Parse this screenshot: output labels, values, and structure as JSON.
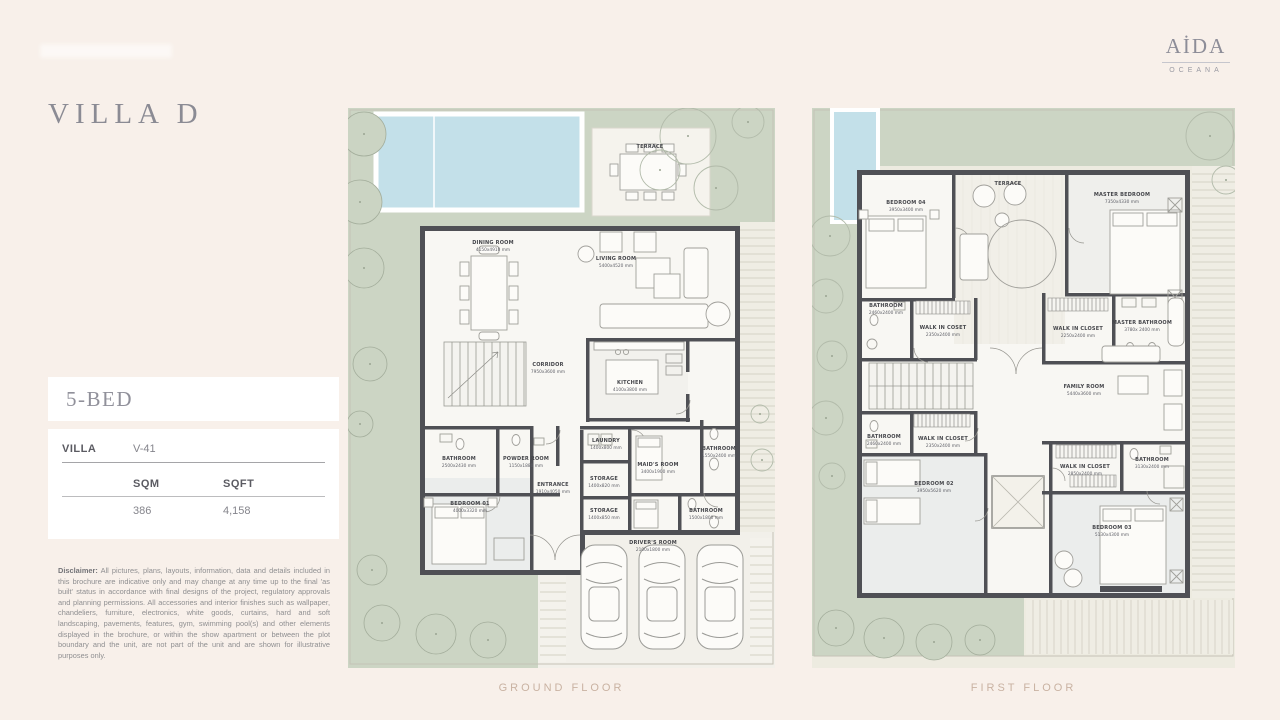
{
  "brand": {
    "name": "AİDA",
    "sub": "OCEANA"
  },
  "page": {
    "title": "VILLA D"
  },
  "unit": {
    "bed_label": "5-BED",
    "villa_label": "VILLA",
    "villa_value": "V-41",
    "sqm_label": "SQM",
    "sqft_label": "SQFT",
    "sqm_value": "386",
    "sqft_value": "4,158"
  },
  "disclaimer": {
    "label": "Disclaimer:",
    "text": "All pictures, plans, layouts, information, data and details included in this brochure are indicative only and may change at any time up to the final 'as built' status in accordance with final designs of the project, regulatory approvals and planning permissions. All accessories and interior finishes such as wallpaper, chandeliers, furniture, electronics, white goods, curtains, hard and soft landscaping, pavements, features, gym, swimming pool(s) and other elements displayed in the brochure, or within the show apartment or between the plot boundary and the unit, are not part of the unit and are shown for illustrative purposes only."
  },
  "floors": {
    "ground": {
      "caption": "GROUND FLOOR",
      "rooms": [
        {
          "name": "TERRACE",
          "dims": ""
        },
        {
          "name": "DINING ROOM",
          "dims": "4150x4910 mm"
        },
        {
          "name": "LIVING ROOM",
          "dims": "5400x4520 mm"
        },
        {
          "name": "CORRIDOR",
          "dims": "7950x3600 mm"
        },
        {
          "name": "KITCHEN",
          "dims": "4100x3800 mm"
        },
        {
          "name": "LAUNDRY",
          "dims": "1400x800 mm"
        },
        {
          "name": "MAID'S ROOM",
          "dims": "3400x1900 mm"
        },
        {
          "name": "BATHROOM",
          "dims": "1550x2400 mm"
        },
        {
          "name": "ENTRANCE",
          "dims": "1910x4050 mm"
        },
        {
          "name": "STORAGE",
          "dims": "1400x820 mm"
        },
        {
          "name": "STORAGE",
          "dims": "1400x850 mm"
        },
        {
          "name": "DRIVER'S ROOM",
          "dims": "2100x1800 mm"
        },
        {
          "name": "BATHROOM",
          "dims": "1500x1800 mm"
        },
        {
          "name": "POWDER ROOM",
          "dims": "1150x1880 mm"
        },
        {
          "name": "BATHROOM",
          "dims": "2500x2430 mm"
        },
        {
          "name": "BEDROOM 01",
          "dims": "4000x3320 mm"
        }
      ]
    },
    "first": {
      "caption": "FIRST FLOOR",
      "rooms": [
        {
          "name": "TERRACE",
          "dims": ""
        },
        {
          "name": "BEDROOM 04",
          "dims": "3950x3400 mm"
        },
        {
          "name": "MASTER BEDROOM",
          "dims": "7350x4330 mm"
        },
        {
          "name": "BATHROOM",
          "dims": "2460x2400 mm"
        },
        {
          "name": "WALK IN COSET",
          "dims": "2350x2400 mm"
        },
        {
          "name": "WALK IN CLOSET",
          "dims": "2250x2400 mm"
        },
        {
          "name": "MASTER BATHROOM",
          "dims": "3780x 2400 mm"
        },
        {
          "name": "FAMILY ROOM",
          "dims": "5440x3600 mm"
        },
        {
          "name": "BATHROOM",
          "dims": "2460x2400 mm"
        },
        {
          "name": "WALK IN CLOSET",
          "dims": "2350x2400 mm"
        },
        {
          "name": "BEDROOM 02",
          "dims": "3950x5620 mm"
        },
        {
          "name": "WALK IN CLOSET",
          "dims": "2850x2400 mm"
        },
        {
          "name": "BATHROOM",
          "dims": "3130x2400 mm"
        },
        {
          "name": "BEDROOM 03",
          "dims": "5130x4300 mm"
        }
      ]
    }
  },
  "colors": {
    "page_bg": "#f8f0ea",
    "wall": "#4f5055",
    "garden": "#ccd5c4",
    "pool": "#c3e0e9",
    "caption": "#c9b2a2",
    "title": "#8b8b94"
  }
}
